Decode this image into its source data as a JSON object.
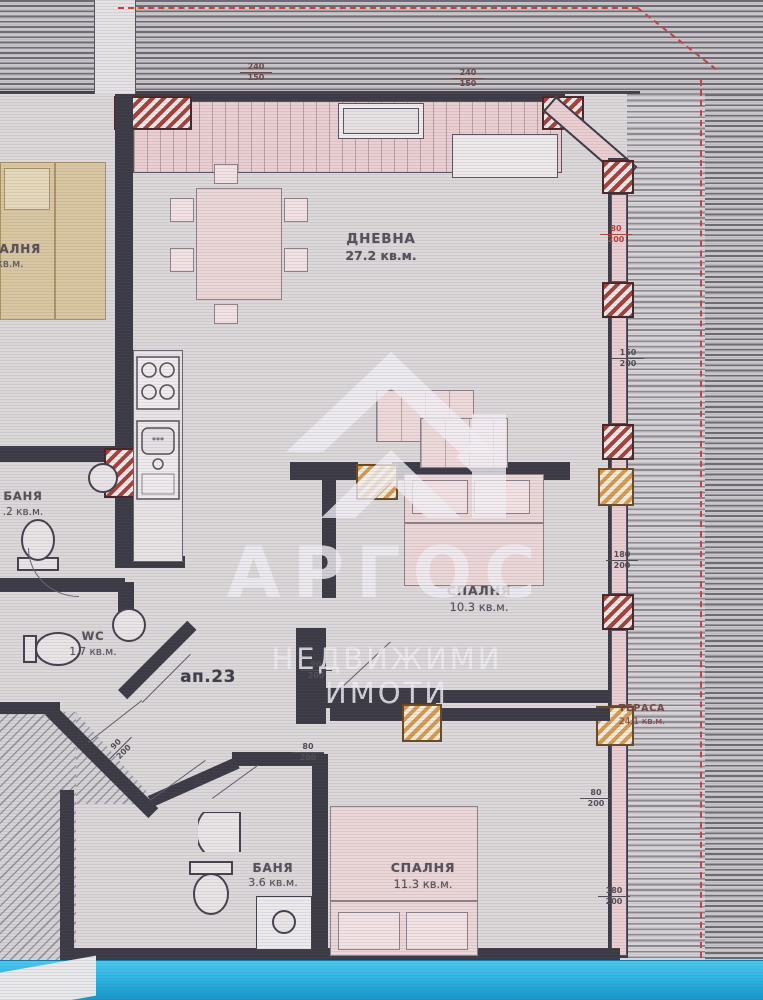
{
  "labels": {
    "living": {
      "name": "ДНЕВНА",
      "area": "27.2 кв.м."
    },
    "bedroom_mid": {
      "name": "СПАЛНЯ",
      "area": "10.3 кв.м."
    },
    "bedroom_bottom": {
      "name": "СПАЛНЯ",
      "area": "11.3 кв.м."
    },
    "bath_bottom": {
      "name": "БАНЯ",
      "area": "3.6 кв.м."
    },
    "wc": {
      "name": "WC",
      "area": "1.7 кв.м."
    },
    "terrace": {
      "name": "ТЕРАСА",
      "area": "24.1 кв.м."
    },
    "neighbor_bedroom": {
      "name": "СПАЛНЯ",
      "area": "кв.м."
    },
    "neighbor_bath": {
      "name": "БАНЯ",
      "area": ".2 кв.м."
    },
    "apartment": "ап.23",
    "door_letter": "д",
    "kitchen_marks": "***"
  },
  "dimensions": [
    {
      "top": "240",
      "bottom": "150"
    },
    {
      "top": "240",
      "bottom": "150"
    },
    {
      "top": "80",
      "bottom": "200"
    },
    {
      "top": "150",
      "bottom": "200"
    },
    {
      "top": "180",
      "bottom": "200"
    },
    {
      "top": "90",
      "bottom": "200"
    },
    {
      "top": "80",
      "bottom": "200"
    },
    {
      "top": "80",
      "bottom": "200"
    },
    {
      "top": "180",
      "bottom": "200"
    },
    {
      "top": "90",
      "bottom": "200"
    }
  ],
  "watermark": {
    "brand": "АРГОС",
    "tagline": "НЕДВИЖИМИ ИМОТИ"
  },
  "colors": {
    "wall": "#3c3a45",
    "window_pink": "#e9ced2",
    "column_red": "#a8403a",
    "door_orange": "#d79a4e",
    "boundary_dash_red": "#c34440",
    "dimension_red": "#b5423c",
    "bottom_strip_blue": "#2ab5e4"
  }
}
